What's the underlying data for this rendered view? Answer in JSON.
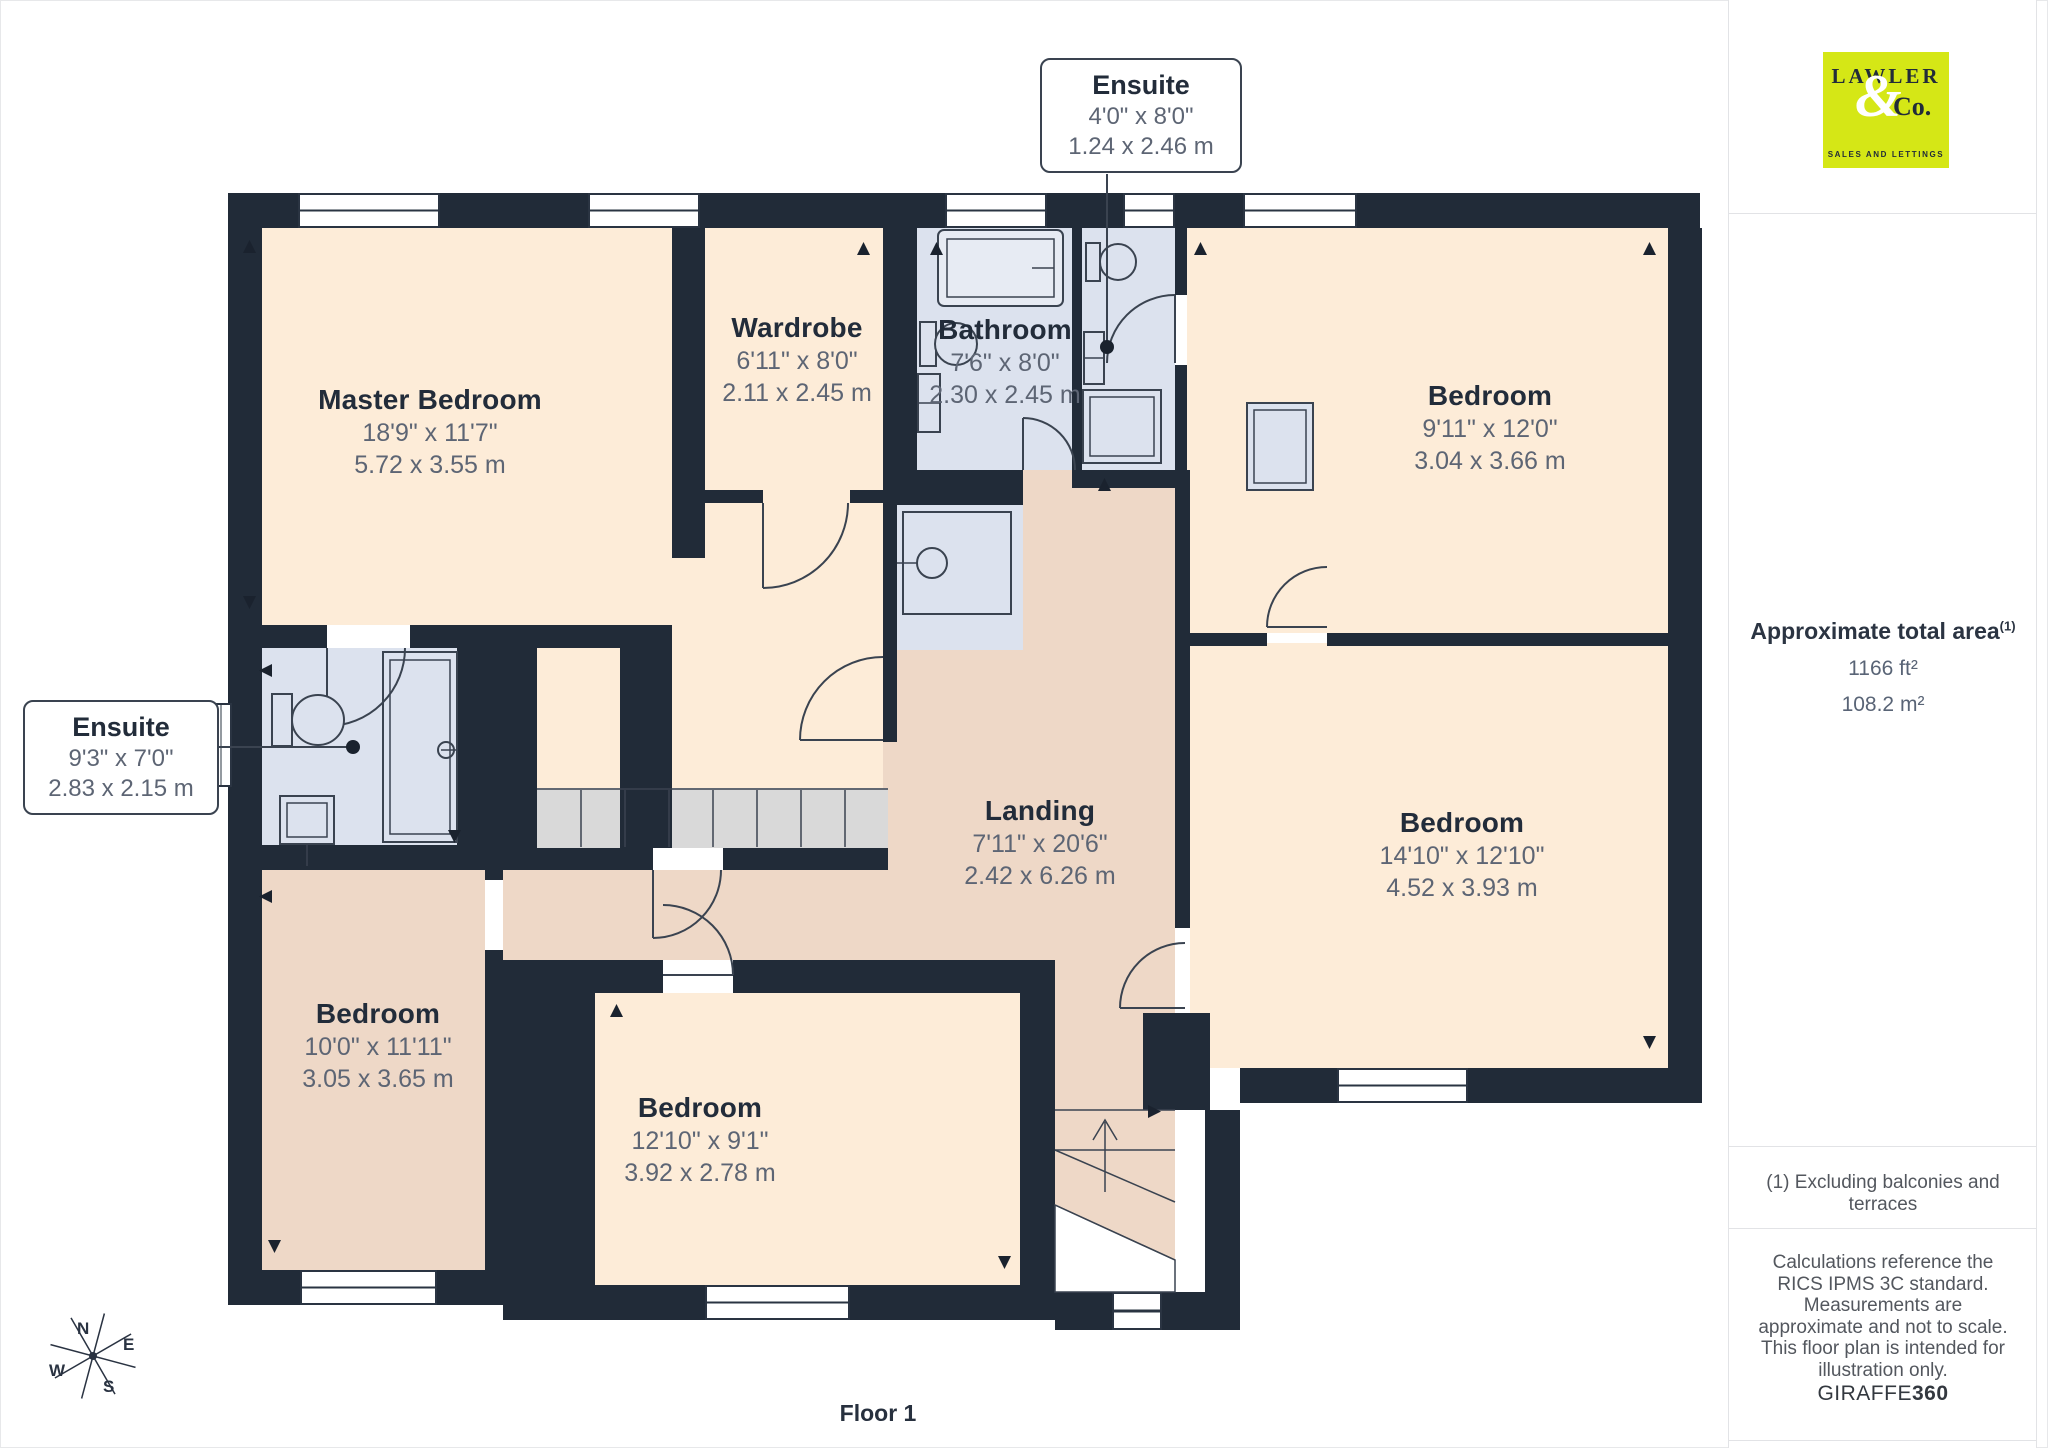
{
  "floorplan": {
    "floor_label": "Floor 1",
    "rooms": [
      {
        "name": "Master Bedroom",
        "dims_imperial": "18'9\" x 11'7\"",
        "dims_metric": "5.72 x 3.55 m"
      },
      {
        "name": "Wardrobe",
        "dims_imperial": "6'11\" x 8'0\"",
        "dims_metric": "2.11 x 2.45 m"
      },
      {
        "name": "Bathroom",
        "dims_imperial": "7'6\" x 8'0\"",
        "dims_metric": "2.30 x 2.45 m"
      },
      {
        "name": "Bedroom",
        "dims_imperial": "9'11\" x 12'0\"",
        "dims_metric": "3.04 x 3.66 m"
      },
      {
        "name": "Bedroom",
        "dims_imperial": "14'10\" x 12'10\"",
        "dims_metric": "4.52 x 3.93 m"
      },
      {
        "name": "Landing",
        "dims_imperial": "7'11\" x 20'6\"",
        "dims_metric": "2.42 x 6.26 m"
      },
      {
        "name": "Bedroom",
        "dims_imperial": "10'0\" x 11'11\"",
        "dims_metric": "3.05 x 3.65 m"
      },
      {
        "name": "Bedroom",
        "dims_imperial": "12'10\" x 9'1\"",
        "dims_metric": "3.92 x 2.78 m"
      }
    ],
    "callouts": [
      {
        "name": "Ensuite",
        "dims_imperial": "4'0\" x 8'0\"",
        "dims_metric": "1.24 x 2.46 m"
      },
      {
        "name": "Ensuite",
        "dims_imperial": "9'3\" x 7'0\"",
        "dims_metric": "2.83 x 2.15 m"
      }
    ],
    "compass": {
      "n": "N",
      "e": "E",
      "s": "S",
      "w": "W"
    }
  },
  "sidebar": {
    "logo": {
      "line1": "LAWLER",
      "amp": "&",
      "line2": "Co.",
      "tagline": "SALES AND LETTINGS"
    },
    "area": {
      "title": "Approximate total area",
      "superscript": "(1)",
      "value_imperial": "1166 ft²",
      "value_metric": "108.2 m²"
    },
    "note_excluding": "(1) Excluding balconies and terraces",
    "disclaimer": "Calculations reference the RICS IPMS 3C standard. Measurements are approximate and not to scale. This floor plan is intended for illustration only.",
    "brand": {
      "name": "GIRAFFE",
      "suffix": "360"
    }
  },
  "colors": {
    "wall": "#212b38",
    "room_cream": "#fdecd8",
    "room_pink": "#eed8c7",
    "wet_room": "#dce2ee",
    "stairs_gray": "#d9d9d9",
    "logo_accent": "#d5e716",
    "label_navy": "#222c3a",
    "dims_gray": "#5d6574"
  }
}
